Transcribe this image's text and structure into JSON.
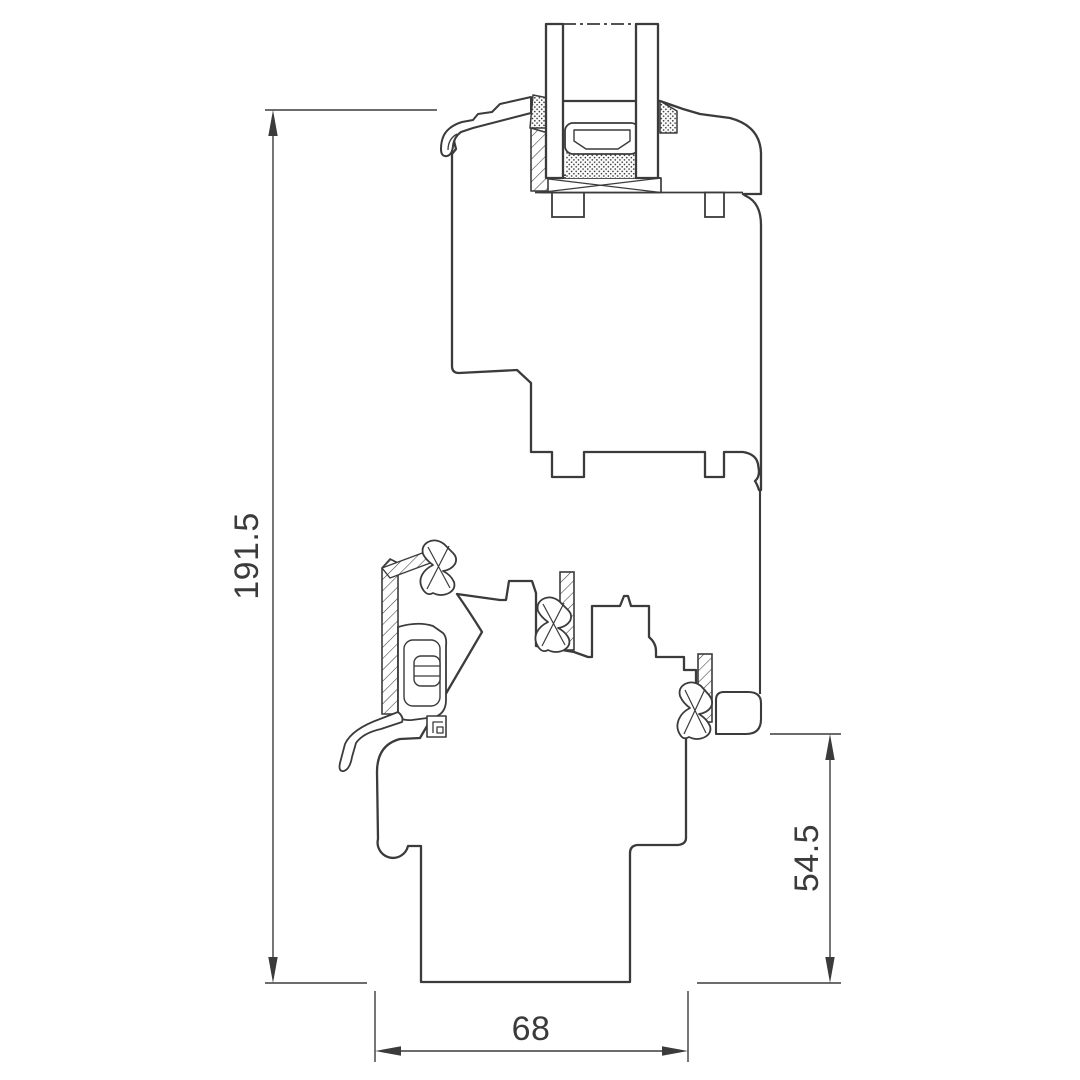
{
  "drawing": {
    "type": "technical-cross-section",
    "subject": "window-frame-sash-profile",
    "dimensions": {
      "overall_height": "191.5",
      "frame_height": "54.5",
      "frame_depth": "68"
    },
    "colors": {
      "line": "#3b3b3b",
      "background": "#ffffff"
    }
  }
}
